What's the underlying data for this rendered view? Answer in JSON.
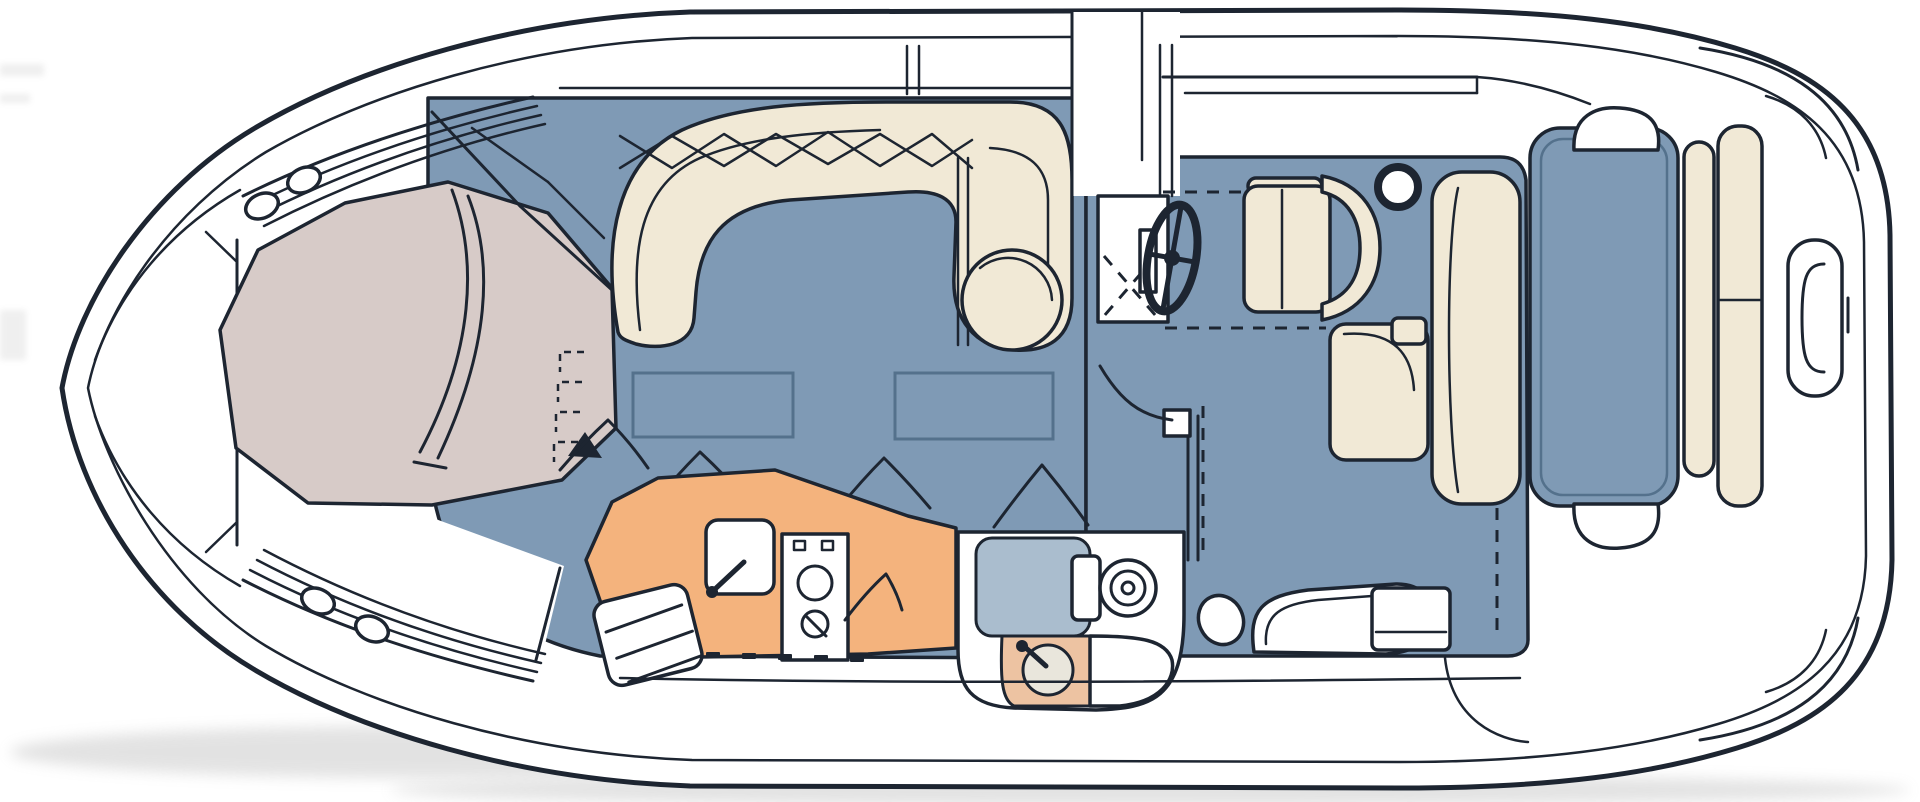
{
  "document": {
    "type": "boat-floor-plan-illustration",
    "title": "Motor yacht interior deck plan, top view line drawing"
  },
  "colors": {
    "ink": "#1d2531",
    "paper": "#ffffff",
    "floor_blue": "#7f9ab5",
    "floor_blue_dark": "#54718c",
    "upholstery_cream": "#f1e9d6",
    "berth_mauve": "#d7cbc8",
    "galley_orange": "#f4b37d",
    "counter_peach": "#edc3a2",
    "shower_blue": "#aabdce",
    "basin_grey": "#e9e6dc",
    "shadow_grey": "#9a9a9a"
  },
  "features": {
    "hull": "Boat hull outline, top view",
    "bow_deck": "Bow deck",
    "port_lights": "Bow deck port lights",
    "anchor_locker": "Bow anchor locker bulkhead",
    "v_berth": "Forward V-berth cabin",
    "berth_ladder": "V-berth entry step markers",
    "cabin_steps": "Steps down to bow cabin",
    "salon_floor": "Salon floor",
    "floor_hatches": "Salon floor storage hatches",
    "settee": "U-shaped salon settee",
    "galley": "Galley counter",
    "galley_sink": "Galley sink with faucet",
    "stove": "Two-burner stove",
    "galley_steps": "Companionway steps at galley",
    "head": "Head compartment",
    "shower": "Shower pan",
    "toilet": "Toilet",
    "vanity": "Vanity sink with faucet",
    "companionway": "Windshield walk-through",
    "helm_console": "Helm console",
    "steering_wheel": "Steering wheel",
    "helm_seat": "Helm seat",
    "cockpit_floor": "Cockpit floor",
    "cockpit_lounge": "Cockpit side lounge",
    "drink_table": "Cockpit drink holder ring",
    "mid_cabin": "Mid-cabin berth outline below cockpit (dashed)",
    "aft_bench": "Aft bench seat group",
    "sunpad": "Aft sun pad",
    "transom": "Transom seat cushions",
    "swim_platform": "Swim platform with grab rail"
  }
}
